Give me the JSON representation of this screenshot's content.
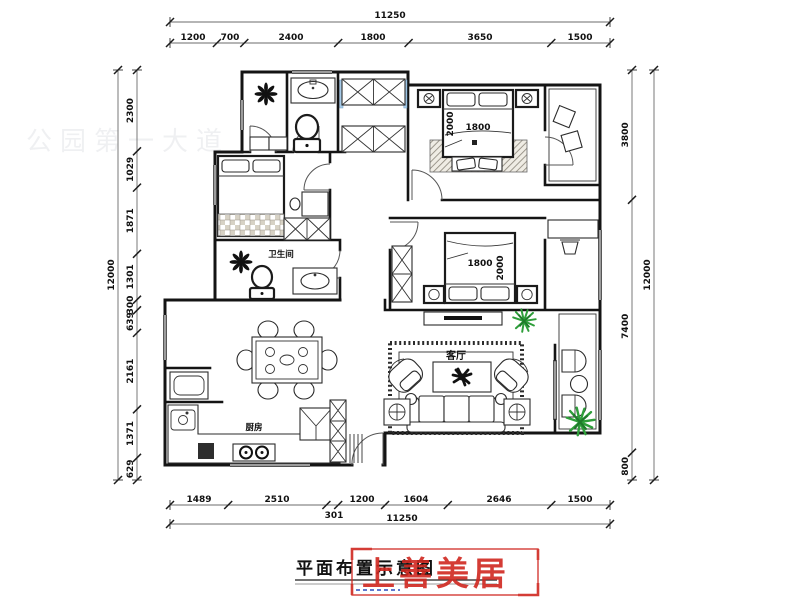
{
  "title": {
    "text": "平面布置示意图"
  },
  "logo": {
    "text": "上善美居"
  },
  "watermark": {
    "text": "公园第一大道"
  },
  "labels": {
    "living": "客厅",
    "bath": "卫生间",
    "kitchen": "厨房"
  },
  "beds": {
    "master": {
      "width": "1800",
      "length": "2000"
    },
    "second": {
      "width": "1800",
      "length": "2000"
    }
  },
  "dims": {
    "top": {
      "total": "11250",
      "segments": [
        "1200",
        "700",
        "2400",
        "1800",
        "3650",
        "1500"
      ]
    },
    "bottom": {
      "total": "11250",
      "segments": [
        "1489",
        "2510",
        "301",
        "1200",
        "1604",
        "2646",
        "1500"
      ]
    },
    "left": {
      "total": "12000",
      "segments": [
        "2300",
        "1029",
        "1871",
        "1301",
        "300",
        "639",
        "2161",
        "1371",
        "629"
      ]
    },
    "right": {
      "total": "12000",
      "segments": [
        "3800",
        "7400",
        "800"
      ]
    }
  },
  "colors": {
    "accent_red": "#d02820",
    "plant_green": "#2e9e3a",
    "window_blue": "#a9cdea"
  }
}
